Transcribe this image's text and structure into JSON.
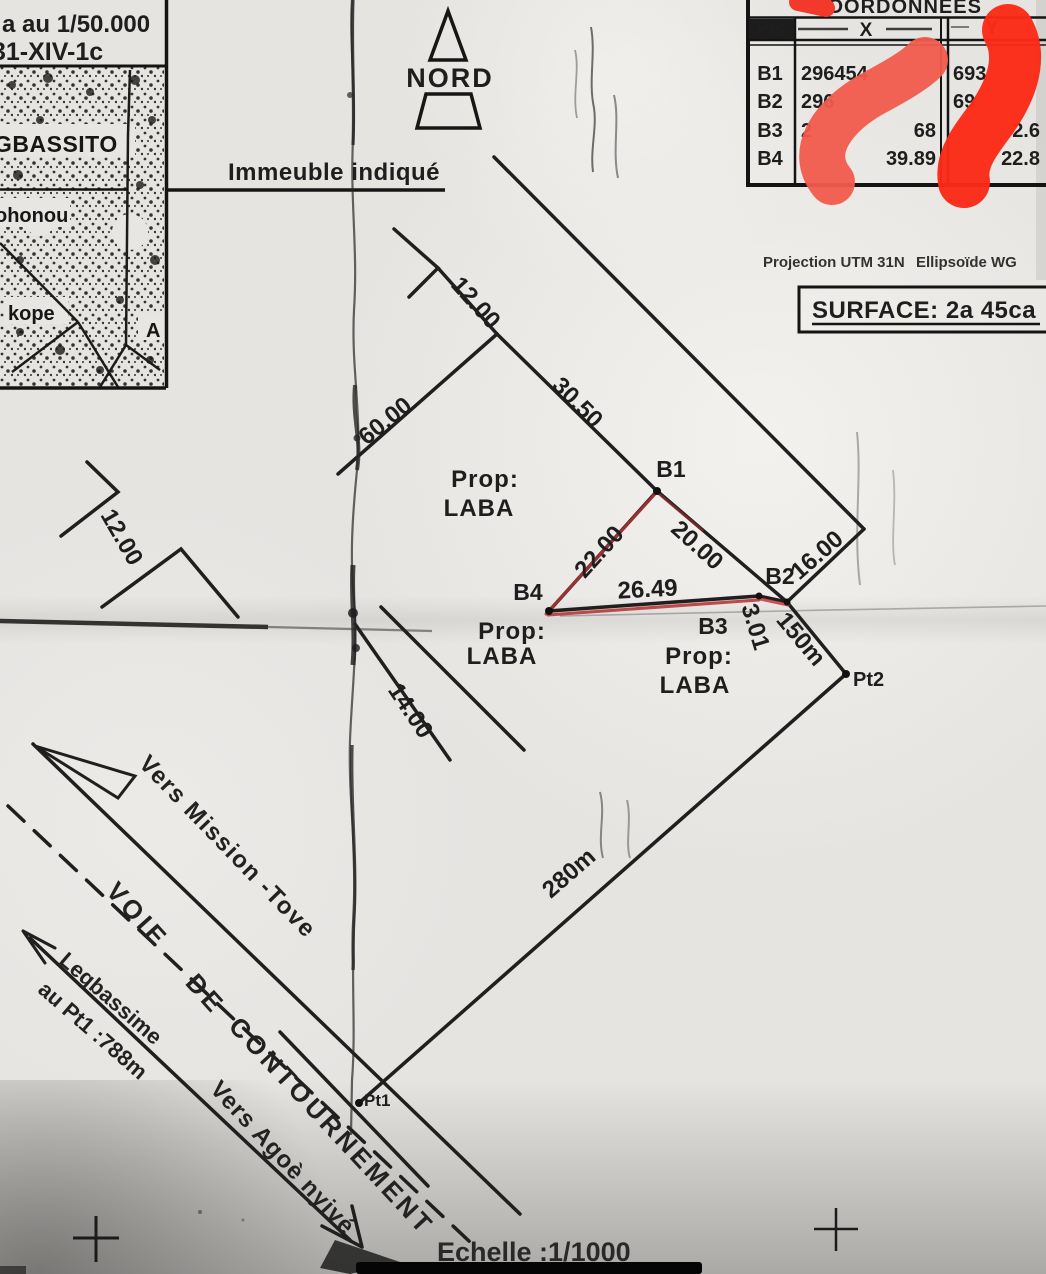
{
  "meta": {
    "paper_color": "#e6e4e1",
    "ink_color": "#1e1e1e",
    "red_marker_light": "#f25b4c",
    "red_marker_bright": "#fb2a18",
    "parcel_red": "#b23434"
  },
  "inset_map": {
    "scale_line": "a au 1/50.000",
    "sheet_line": "31-XIV-1c",
    "place_top": "GBASSITO",
    "place_mid": "ohonou",
    "place_bottom": "kope",
    "marker_a": "A"
  },
  "north_arrow": {
    "label": "NORD"
  },
  "notes": {
    "building": "Immeuble indiqué",
    "projection_1": "Projection UTM 31N",
    "projection_2": "Ellipsoïde WG",
    "surface": "SURFACE: 2a 45ca",
    "scale": "Echelle :1/1000"
  },
  "coord_table": {
    "title": "COORDONNÉES",
    "col_pts": "Pts",
    "col_x": "X",
    "col_y": "Y",
    "rows": [
      {
        "pt": "B1",
        "x_left": "296454",
        "x_right": "",
        "y_left": "693",
        "y_right": ""
      },
      {
        "pt": "B2",
        "x_left": "296",
        "x_right": "",
        "y_left": "69",
        "y_right": ""
      },
      {
        "pt": "B3",
        "x_left": "2",
        "x_right": "68",
        "y_left": "",
        "y_right": "2.6"
      },
      {
        "pt": "B4",
        "x_left": "",
        "x_right": "39.89",
        "y_left": "",
        "y_right": "22.8"
      }
    ]
  },
  "parcel": {
    "owner_prefix": "Prop:",
    "owner_name": "LABA",
    "b1": "B1",
    "b2": "B2",
    "b3": "B3",
    "b4": "B4",
    "pt1": "Pt1",
    "pt2": "Pt2",
    "len_b1_b4": "22.00",
    "len_b1_b2": "20.00",
    "len_b4_b3": "26.49",
    "len_b3_b2": "3.01",
    "dim_12_top": "12.00",
    "dim_30_50": "30.50",
    "dim_60": "60.00",
    "dim_12_left": "12.00",
    "dim_14": "14.00",
    "dim_16": "16.00",
    "dist_150": "150m",
    "dist_280": "280m"
  },
  "roads": {
    "to_mission": "Vers Mission -Tove",
    "voie_word1": "VOIE",
    "voie_word2": "DE",
    "voie_word3": "CONTOURNEMENT",
    "legbassime_line1": "Legbassime",
    "legbassime_line2": "au Pt1 :788m",
    "to_agoe": "Vers Agoè nyivé"
  }
}
